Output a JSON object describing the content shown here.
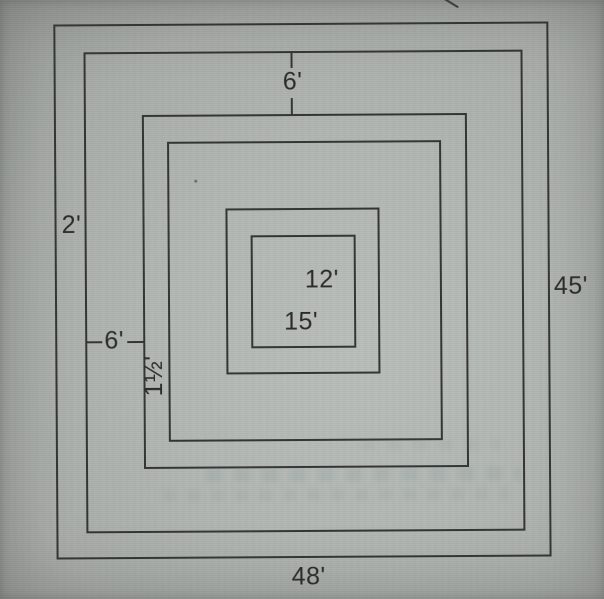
{
  "figure": {
    "type": "nested-rectangles-dimension-diagram",
    "description": "Six concentric rectangles with dimension labels (photographed textbook figure)",
    "labels": {
      "top_gap": "6'",
      "left_outer_gap": "2'",
      "left_middle_gap": "6'",
      "left_inner_gap": "1½'",
      "innermost_width": "12'",
      "innermost_height": "15'",
      "right_side": "45'",
      "bottom_side": "48'"
    },
    "colors": {
      "paper": "#b2b7b3",
      "line": "#343634",
      "text": "#2b2c2b"
    }
  }
}
